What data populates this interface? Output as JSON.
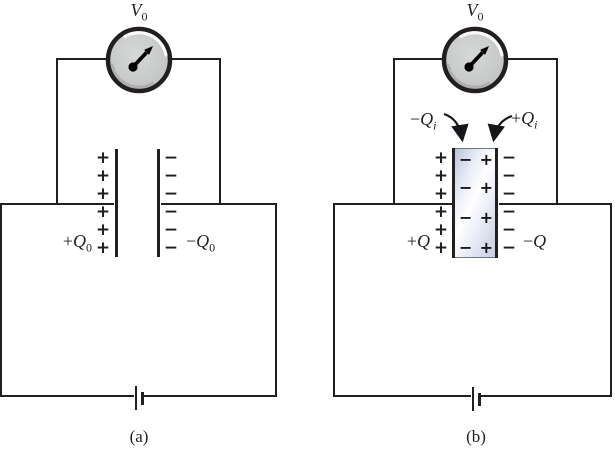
{
  "colors": {
    "line": "#231f20",
    "meter_face": "#c8cac9",
    "meter_highlight": "#ffffff",
    "dielectric_tint": "#c2cbdf"
  },
  "panels": [
    {
      "caption": "(a)",
      "meter": {
        "label": "V",
        "sub": "0"
      },
      "left_label": {
        "sign": "+",
        "symbol": "Q",
        "sub": "0"
      },
      "right_label": {
        "sign": "−",
        "symbol": "Q",
        "sub": "0"
      },
      "left_charges": [
        "+",
        "+",
        "+",
        "+",
        "+",
        "+"
      ],
      "right_charges": [
        "−",
        "−",
        "−",
        "−",
        "−",
        "−"
      ]
    },
    {
      "caption": "(b)",
      "meter": {
        "label": "V",
        "sub": "0"
      },
      "left_label": {
        "sign": "+",
        "symbol": "Q",
        "sub": ""
      },
      "right_label": {
        "sign": "−",
        "symbol": "Q",
        "sub": ""
      },
      "induced_left_label": {
        "sign": "−",
        "symbol": "Q",
        "sub": "i"
      },
      "induced_right_label": {
        "sign": "+",
        "symbol": "Q",
        "sub": "i"
      },
      "left_charges": [
        "+",
        "+",
        "+",
        "+",
        "+",
        "+"
      ],
      "right_charges": [
        "−",
        "−",
        "−",
        "−",
        "−",
        "−"
      ],
      "dielectric_pairs": [
        [
          "−",
          "+"
        ],
        [
          "−",
          "+"
        ],
        [
          "−",
          "+"
        ],
        [
          "−",
          "+"
        ]
      ]
    }
  ]
}
